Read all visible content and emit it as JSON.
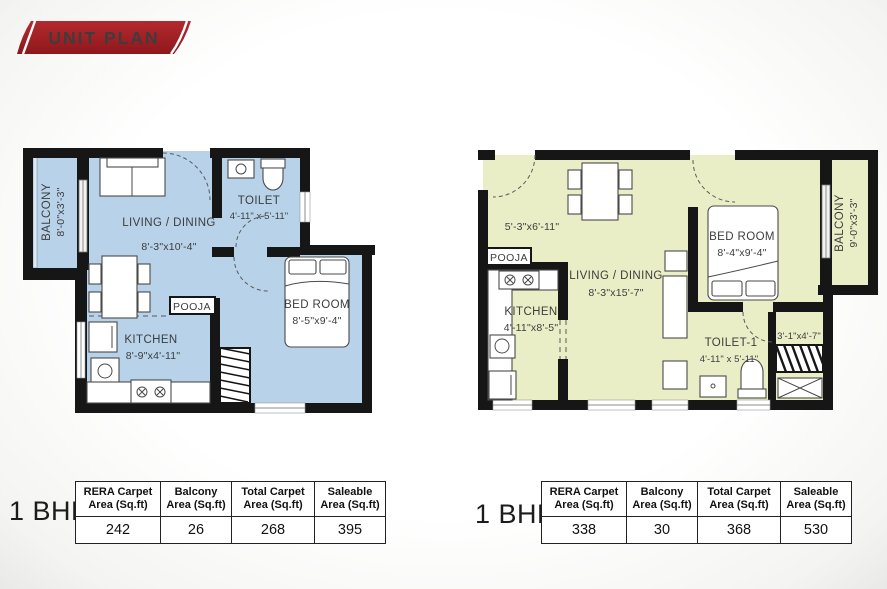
{
  "title": "UNIT PLAN",
  "colors": {
    "plan_a_fill": "#b7d2e9",
    "plan_b_fill": "#eaeec6",
    "wall": "#161616",
    "ribbon_top": "#b42a2e",
    "ribbon_bottom": "#8e171c"
  },
  "plan_a": {
    "balcony_name": "BALCONY",
    "balcony_dim": "8'-0\"x3'-3\"",
    "living_name": "LIVING / DINING",
    "living_dim": "8'-3\"x10'-4\"",
    "toilet_name": "TOILET",
    "toilet_dim": "4'-11\" x 5'-11\"",
    "bedroom_name": "BED ROOM",
    "bedroom_dim": "8'-5\"x9'-4\"",
    "kitchen_name": "KITCHEN",
    "kitchen_dim": "8'-9\"x4'-11\"",
    "pooja": "POOJA"
  },
  "plan_b": {
    "foyer_dim": "5'-3\"x6'-11\"",
    "pooja": "POOJA",
    "kitchen_name": "KITCHEN",
    "kitchen_dim": "4'-11\"x8'-5\"",
    "living_name": "LIVING / DINING",
    "living_dim": "8'-3\"x15'-7\"",
    "bedroom_name": "BED ROOM",
    "bedroom_dim": "8'-4\"x9'-4\"",
    "balcony_name": "BALCONY",
    "balcony_dim": "9'-0\"x3'-3\"",
    "toilet_name": "TOILET-1",
    "toilet_dim": "4'-11\" x 5'-11\"",
    "ledge_dim": "3'-1\"x4'-7\""
  },
  "table_a": {
    "unit_label": "1 BHK",
    "headers": [
      [
        "RERA Carpet",
        "Area (Sq.ft)"
      ],
      [
        "Balcony",
        "Area (Sq.ft)"
      ],
      [
        "Total Carpet",
        "Area (Sq.ft)"
      ],
      [
        "Saleable",
        "Area (Sq.ft)"
      ]
    ],
    "values": [
      "242",
      "26",
      "268",
      "395"
    ]
  },
  "table_b": {
    "unit_label": "1 BHK",
    "headers": [
      [
        "RERA Carpet",
        "Area (Sq.ft)"
      ],
      [
        "Balcony",
        "Area (Sq.ft)"
      ],
      [
        "Total Carpet",
        "Area (Sq.ft)"
      ],
      [
        "Saleable",
        "Area (Sq.ft)"
      ]
    ],
    "values": [
      "338",
      "30",
      "368",
      "530"
    ]
  }
}
